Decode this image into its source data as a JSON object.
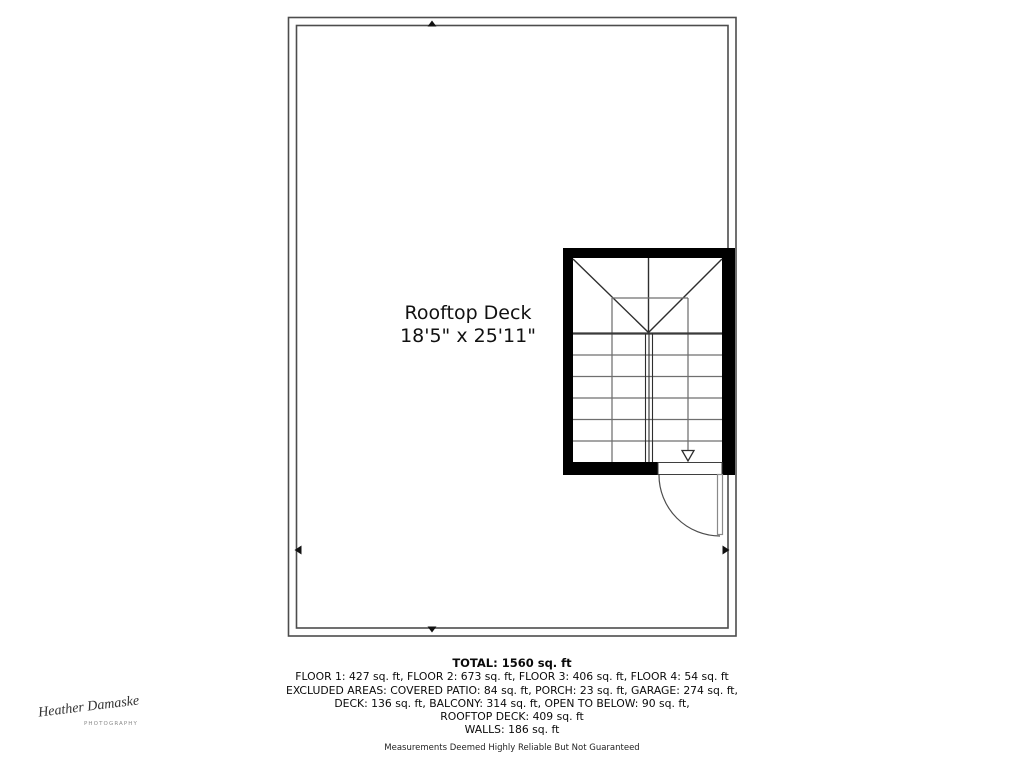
{
  "plan": {
    "room_name": "Rooftop Deck",
    "room_dimensions": "18'5\" x 25'11\"",
    "stairs_direction": "down"
  },
  "summary": {
    "total_line": "TOTAL: 1560 sq. ft",
    "lines": [
      "FLOOR 1: 427 sq. ft, FLOOR 2: 673 sq. ft, FLOOR 3: 406 sq. ft, FLOOR 4: 54 sq. ft",
      "EXCLUDED AREAS: COVERED PATIO: 84 sq. ft, PORCH: 23 sq. ft, GARAGE: 274 sq. ft,",
      "DECK: 136 sq. ft, BALCONY: 314 sq. ft, OPEN TO BELOW: 90 sq. ft,",
      "ROOFTOP DECK: 409 sq. ft",
      "WALLS: 186 sq. ft"
    ],
    "disclaimer": "Measurements Deemed Highly Reliable But Not Guaranteed"
  },
  "watermark": {
    "signature": "Heather Damaske",
    "subtitle": "PHOTOGRAPHY"
  },
  "colors": {
    "wall": "#4d4d4d",
    "stair_black": "#000000",
    "tread_gray": "#6f6f6f",
    "detail_dark": "#2e2e2e",
    "text": "#111111"
  }
}
